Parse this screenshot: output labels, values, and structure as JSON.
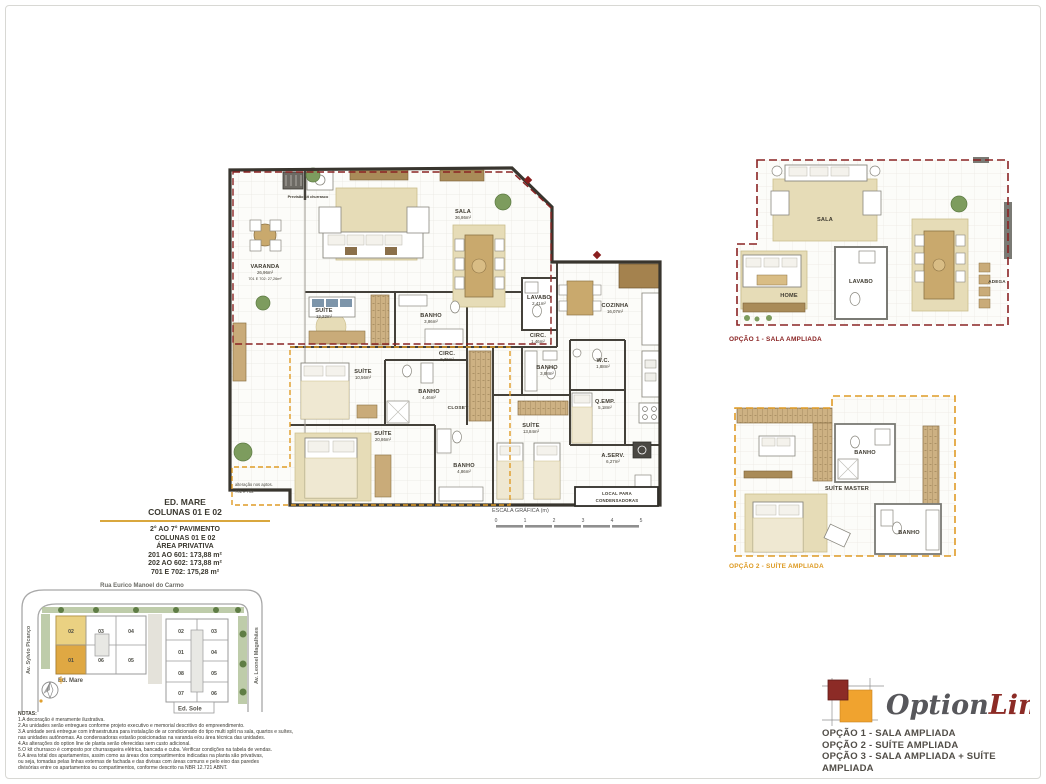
{
  "info_block": {
    "building": "ED. MARE",
    "columns": "COLUNAS 01 E 02",
    "lines": [
      "2° AO 7° PAVIMENTO",
      "COLUNAS 01 E 02",
      "ÁREA PRIVATIVA",
      "201 AO 601: 173,88 m²",
      "202 AO 602: 173,88 m²",
      "701 E 702: 175,28 m²"
    ]
  },
  "scale_bar": {
    "title": "ESCALA GRÁFICA (m)",
    "ticks": [
      "0",
      "1",
      "2",
      "3",
      "4",
      "5"
    ]
  },
  "main_plan": {
    "kit_label": "Previsão kit churrasco",
    "rooms": {
      "varanda": {
        "name": "VARANDA",
        "area": "26,96m²",
        "area2": "701 E 702: 27,26m²"
      },
      "sala": {
        "name": "SALA",
        "area": "36,86m²"
      },
      "suite1": {
        "name": "SUÍTE",
        "area": "12,22m²"
      },
      "banho1": {
        "name": "BANHO",
        "area": "3,86m²"
      },
      "lavabo": {
        "name": "LAVABO",
        "area": "2,41m²"
      },
      "circ1": {
        "name": "CIRC.",
        "area": "1,46m²"
      },
      "cozinha": {
        "name": "COZINHA",
        "area": "16,07m²"
      },
      "circ2": {
        "name": "CIRC.",
        "area": "2,36m²"
      },
      "suite2": {
        "name": "SUÍTE",
        "area": "10,56m²"
      },
      "banho2": {
        "name": "BANHO",
        "area": "4,46m²"
      },
      "closet": {
        "name": "CLOSET"
      },
      "suite_master": {
        "name": "SUÍTE",
        "area": "20,86m²"
      },
      "banho3": {
        "name": "BANHO",
        "area": "4,86m²"
      },
      "suite3": {
        "name": "SUÍTE",
        "area": "13,84m²"
      },
      "banho4": {
        "name": "BANHO",
        "area": "3,88m²"
      },
      "wc": {
        "name": "W.C.",
        "area": "1,88m²"
      },
      "qemp": {
        "name": "Q.EMP.",
        "area": "5,18m²"
      },
      "aserv": {
        "name": "A.SERV.",
        "area": "6,27m²"
      },
      "condensadoras": {
        "line1": "LOCAL PARA",
        "line2": "CONDENSADORAS"
      }
    },
    "note_701": {
      "line1": "alteração nos aptos.",
      "line2": "701 e 702"
    }
  },
  "option1_plan": {
    "caption": "OPÇÃO 1 - SALA AMPLIADA",
    "rooms": {
      "sala": "SALA",
      "home": "HOME",
      "lavabo": "LAVABO",
      "adega": "ADEGA"
    }
  },
  "option2_plan": {
    "caption": "OPÇÃO 2 - SUÍTE AMPLIADA",
    "rooms": {
      "banho_top": "BANHO",
      "suite_master": "SUÍTE MASTER",
      "banho_bottom": "BANHO"
    }
  },
  "site_plan": {
    "streets": {
      "top": "Rua Eurico Manoel do Carmo",
      "left": "Av. Sylvio Picanço",
      "right": "Av. Leonel Magalhães"
    },
    "ed_mare": {
      "label": "Ed. Mare",
      "units_top": [
        "02",
        "03",
        "04"
      ],
      "units_bottom": [
        "01",
        "06",
        "05"
      ],
      "highlighted": [
        "01",
        "02"
      ]
    },
    "ed_sole": {
      "label": "Ed. Sole",
      "units": [
        [
          "02",
          "03"
        ],
        [
          "01",
          "04"
        ],
        [
          "08",
          "05"
        ],
        [
          "07",
          "06"
        ]
      ]
    }
  },
  "notes": {
    "title": "NOTAS:",
    "lines": [
      "1.A decoração é meramente ilustrativa.",
      "2.As unidades serão entregues conforme projeto executivo e memorial descritivo do empreendimento.",
      "3.A unidade será entregue com infraestrutura para instalação de ar condicionado do tipo multi split na sala, quartos e suítes,",
      "nas unidades autônomas. As condensadoras estarão posicionadas na varanda e/ou área técnica das unidades.",
      "4.As alterações do option line de planta serão oferecidas sem custo adicional.",
      "5.O kit churrasco é composto por churrasqueira elétrica, bancada e cuba. Verificar condições na tabela de vendas.",
      "6.A área total dos apartamentos, assim como as áreas dos compartimentos indicadas na planta são privativas,",
      "ou seja, tomadas pelas linhas externas de fachada e das divisas com áreas comuns e pelo eixo das paredes",
      "divisórias entre os apartamentos ou compartimentos, conforme descrito na NBR 12.721 ABNT."
    ]
  },
  "logo": {
    "name_option": "Option",
    "name_line": "Line",
    "options": [
      "OPÇÃO 1 - SALA AMPLIADA",
      "OPÇÃO 2 - SUÍTE AMPLIADA",
      "OPÇÃO 3 - SALA AMPLIADA + SUÍTE AMPLIADA"
    ]
  },
  "colors": {
    "dark_red": "#8a2323",
    "orange": "#dd9a22",
    "gold_rule": "#d9a73e",
    "wall": "#38352e",
    "beige": "#e6dcb7",
    "tan": "#c9ab79",
    "green": "#7d9c5e"
  }
}
